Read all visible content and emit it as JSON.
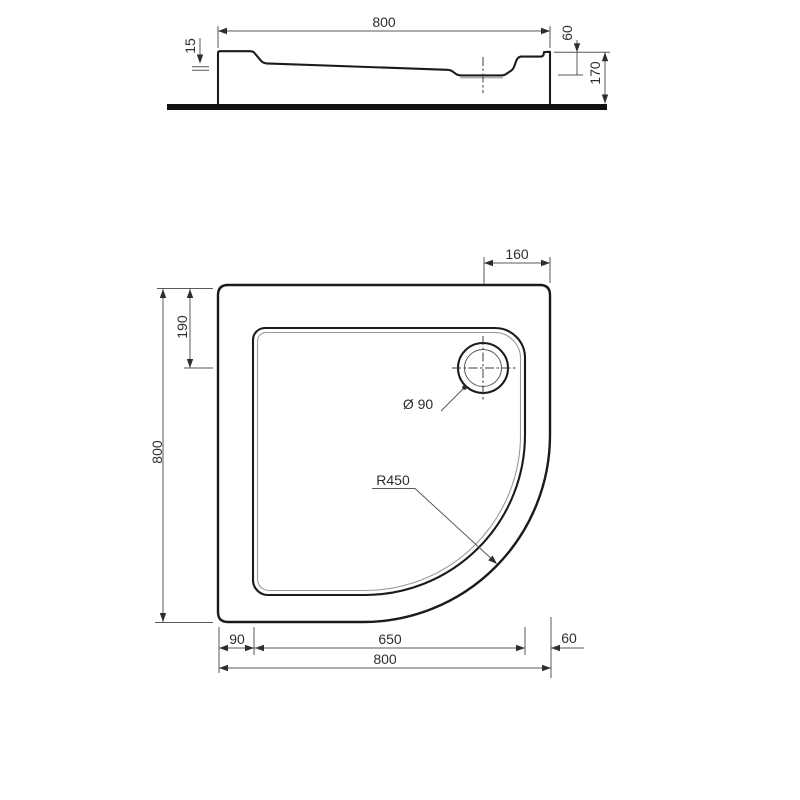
{
  "canvas": {
    "background": "#ffffff",
    "outline_color": "#1b1b1b",
    "dim_line_color": "#5a5a5a",
    "text_color": "#2e2e2e",
    "floor_color": "#111111"
  },
  "side_view": {
    "dims": {
      "overall_width": "800",
      "rim_step": "15",
      "rim_to_basin_depth": "60",
      "overall_height": "170"
    }
  },
  "plan_view": {
    "dims": {
      "drain_offset_from_right": "160",
      "drain_offset_from_top": "190",
      "overall_height": "800",
      "drain_diameter": "Ø 90",
      "front_radius": "R450",
      "left_rim": "90",
      "basin_width": "650",
      "right_rim": "60",
      "overall_width": "800"
    }
  }
}
